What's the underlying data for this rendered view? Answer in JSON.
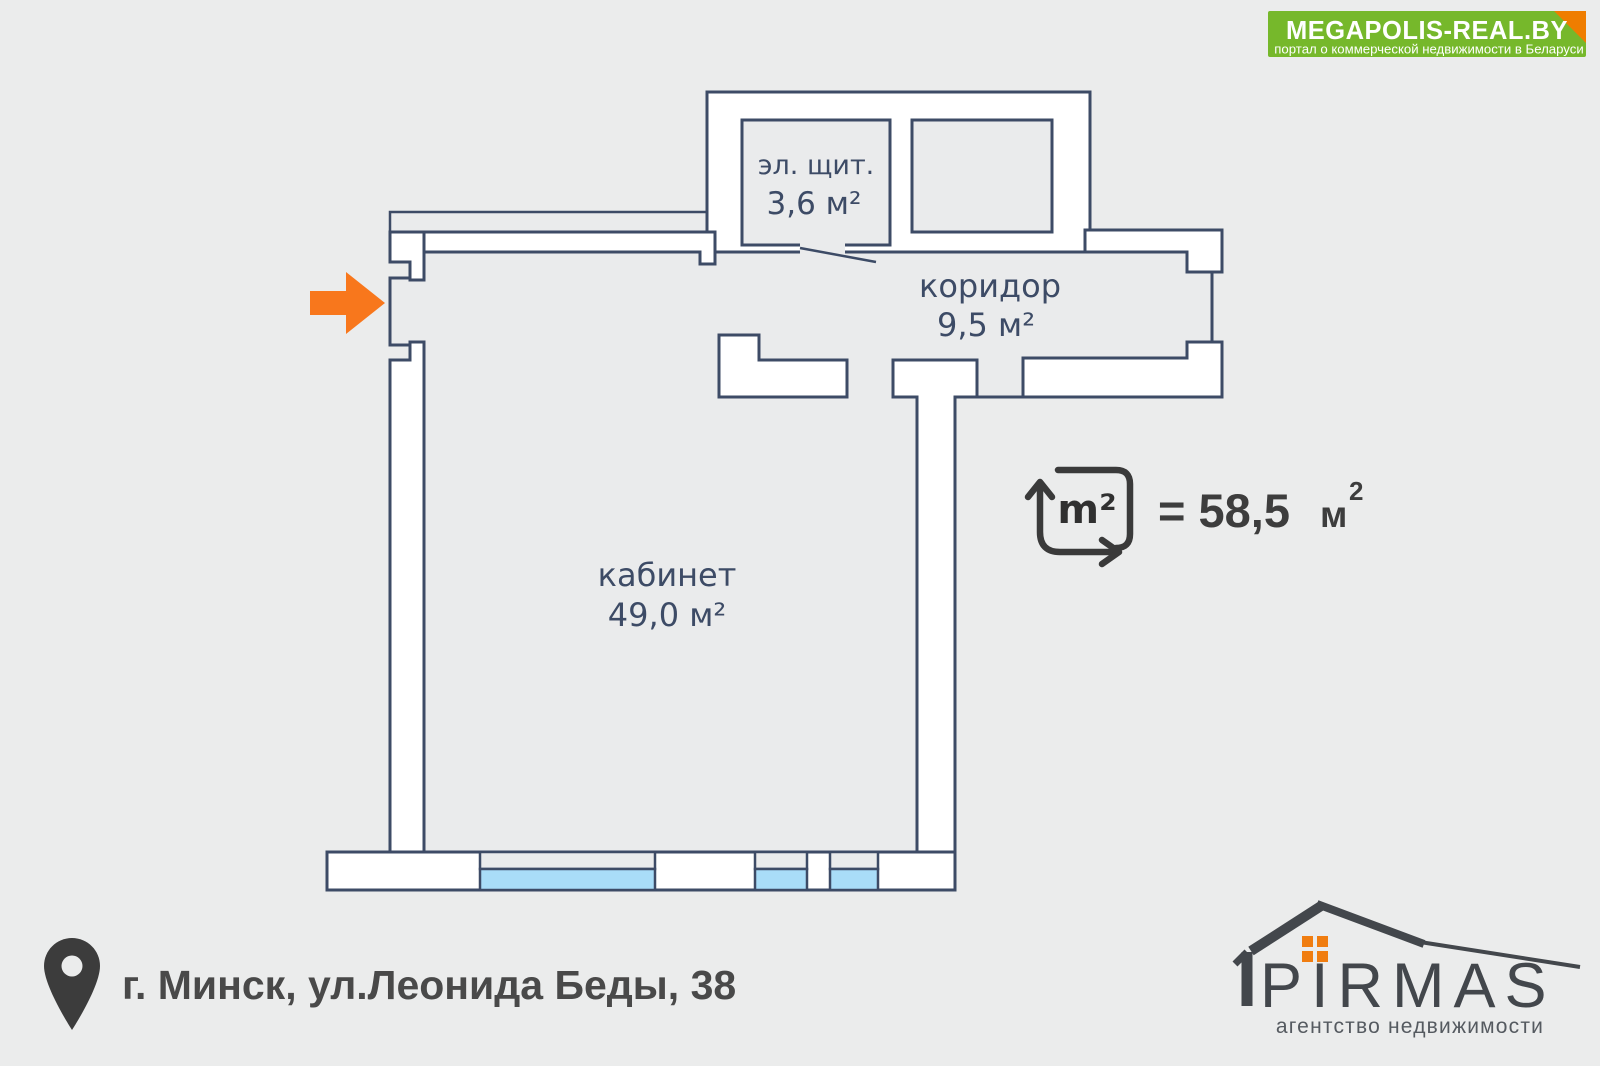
{
  "page": {
    "background": "#ebecec"
  },
  "branding_banner": {
    "title": "MEGAPOLIS-REAL.BY",
    "subtitle": "портал о коммерческой недвижимости в Беларуси",
    "bg_color": "#76b82b",
    "fold_color": "#ef7d00"
  },
  "floor_plan": {
    "wall_color": "#3d4b66",
    "window_color": "#a9ddf8",
    "entrance_arrow_color": "#f8771c",
    "rooms": [
      {
        "name": "эл. щит.",
        "area": "3,6 м²"
      },
      {
        "name": "коридор",
        "area": "9,5 м²"
      },
      {
        "name": "кабинет",
        "area": "49,0 м²"
      }
    ]
  },
  "total_area": {
    "icon_label": "m²",
    "equals_value": "= 58,5",
    "unit": "м",
    "unit_sup": "2"
  },
  "address": {
    "text": "г. Минск, ул.Леонида Беды, 38"
  },
  "agency_logo": {
    "name": "PIRMAS",
    "tagline": "агентство недвижимости",
    "accent": "#f07d10"
  }
}
